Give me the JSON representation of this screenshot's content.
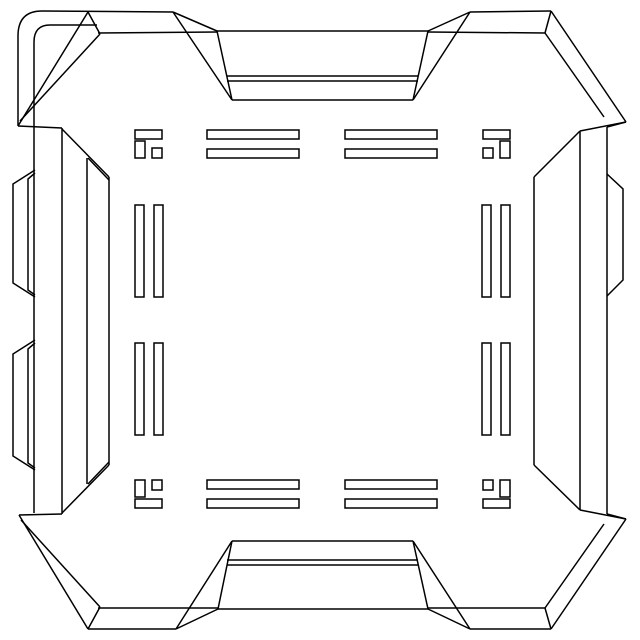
{
  "meta": {
    "canvas": {
      "width": 640,
      "height": 640
    },
    "background_color": "#ffffff",
    "stroke_color": "#000000",
    "stroke_width": 1.5
  },
  "drawing": {
    "groups": [
      {
        "name": "corner-top-left-rounded-hinge",
        "paths": [
          "M18,126 L18,36 Q18,11 42,11 L173,12",
          "M34,513 L34,42 Q34,25 50,25 L97,25",
          "M88,12 L18,126",
          "M100,34 L20,121",
          "M88,12 L100,34",
          "M18,126 L62,128"
        ]
      },
      {
        "name": "corner-top-right-chamfer",
        "paths": [
          "M470,12 L551,11",
          "M551,11 L626,122",
          "M545,33 L604,117",
          "M545,33 L551,11",
          "M626,122 L607,127",
          "M626,122 L580,131"
        ]
      },
      {
        "name": "corner-bottom-left-chamfer",
        "paths": [
          "M88,629 L176,629",
          "M88,629 L19,515",
          "M100,607 L21,520",
          "M88,629 L100,607",
          "M19,515 L62,514"
        ]
      },
      {
        "name": "corner-bottom-right-chamfer",
        "paths": [
          "M470,629 L551,629",
          "M551,629 L626,519",
          "M545,608 L604,524",
          "M545,608 L551,629",
          "M626,519 L607,514",
          "M626,519 L580,510"
        ]
      },
      {
        "name": "latch-tab-top",
        "paths": [
          "M173,12 L217,31",
          "M217,31 L428,31",
          "M428,31 L470,12",
          "M173,12 L232,100",
          "M470,12 L413,100",
          "M217,31 L232,100",
          "M428,31 L413,100",
          "M232,100 L413,100",
          "M227,76 L418,76",
          "M227,81 L418,81",
          "M98,33 L217,32",
          "M428,32 L545,33"
        ]
      },
      {
        "name": "latch-tab-bottom",
        "paths": [
          "M176,629 L218,609",
          "M218,609 L428,609",
          "M428,609 L470,629",
          "M176,629 L232,541",
          "M470,629 L413,541",
          "M218,609 L232,541",
          "M428,609 L413,541",
          "M232,541 L413,541",
          "M227,560 L418,560",
          "M227,565 L418,565",
          "M98,608 L218,608",
          "M428,608 L545,608"
        ]
      },
      {
        "name": "wall-left",
        "paths": [
          "M62,128 L62,514",
          "M87,158 L87,484",
          "M109,177 L109,465",
          "M62,129 L109,177",
          "M88,158 L109,180",
          "M62,513 L109,465",
          "M88,484 L109,462"
        ]
      },
      {
        "name": "wall-right",
        "paths": [
          "M607,127 L607,514",
          "M580,131 L580,510",
          "M534,177 L534,465",
          "M580,131 L534,177",
          "M580,510 L534,465"
        ]
      },
      {
        "name": "hinge-bumps-left",
        "paths": [
          "M35,170 L13,184 L13,283 L35,297",
          "M35,173 L28,179 L28,290 L35,295",
          "M35,340 L13,354 L13,456 L35,470",
          "M35,343 L28,349 L28,463 L35,468"
        ]
      },
      {
        "name": "latch-bump-right",
        "paths": [
          "M607,174 L623,189 L623,280 L607,296"
        ]
      }
    ],
    "contact_slot_ring": {
      "name": "contact-slot-ring",
      "corner_brackets": [
        [
          135,
          130,
          27,
          9
        ],
        [
          135,
          141,
          10,
          17
        ],
        [
          152,
          148,
          10,
          10
        ],
        [
          483,
          130,
          27,
          9
        ],
        [
          500,
          141,
          10,
          17
        ],
        [
          483,
          148,
          10,
          10
        ],
        [
          135,
          499,
          27,
          9
        ],
        [
          135,
          480,
          10,
          17
        ],
        [
          152,
          480,
          10,
          10
        ],
        [
          483,
          499,
          27,
          9
        ],
        [
          500,
          480,
          10,
          17
        ],
        [
          483,
          480,
          10,
          10
        ]
      ],
      "slot_bars": [
        [
          207,
          130,
          92,
          9
        ],
        [
          207,
          149,
          92,
          9
        ],
        [
          345,
          130,
          92,
          9
        ],
        [
          345,
          149,
          92,
          9
        ],
        [
          207,
          480,
          92,
          9
        ],
        [
          207,
          499,
          92,
          9
        ],
        [
          345,
          480,
          92,
          9
        ],
        [
          345,
          499,
          92,
          9
        ],
        [
          135,
          205,
          9,
          92
        ],
        [
          154,
          205,
          9,
          92
        ],
        [
          135,
          343,
          9,
          92
        ],
        [
          154,
          343,
          9,
          92
        ],
        [
          482,
          205,
          9,
          92
        ],
        [
          501,
          205,
          9,
          92
        ],
        [
          482,
          343,
          9,
          92
        ],
        [
          501,
          343,
          9,
          92
        ]
      ]
    }
  }
}
